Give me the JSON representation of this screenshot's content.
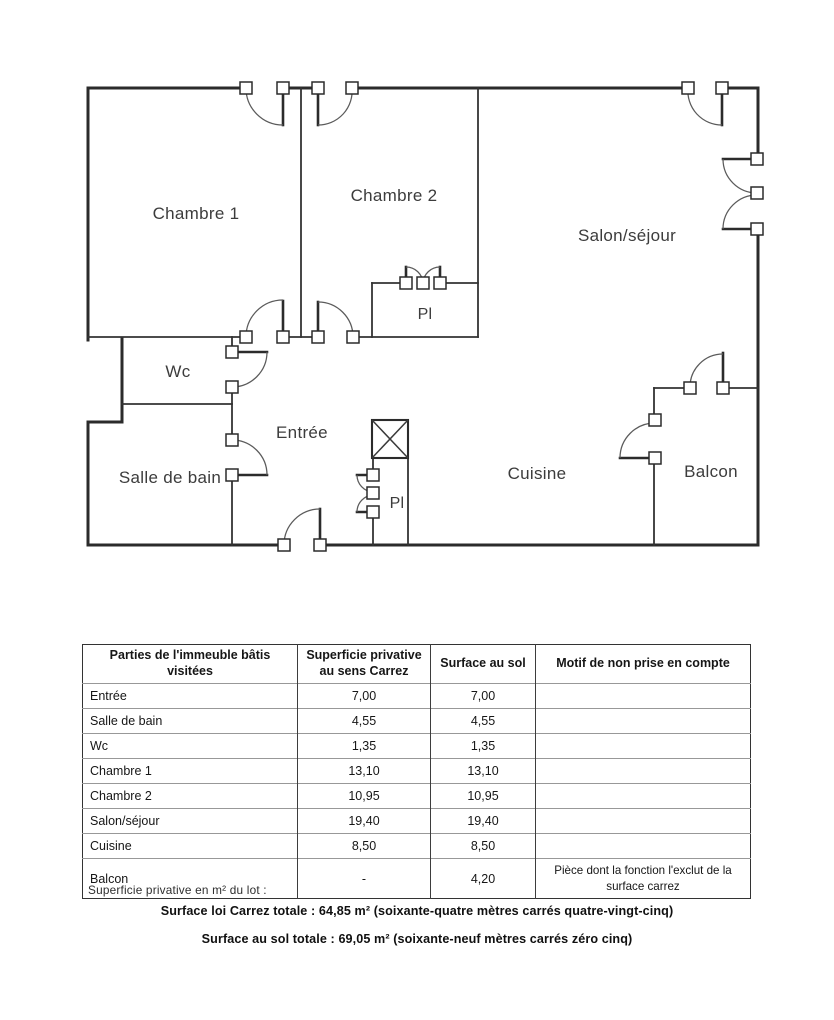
{
  "ink_color": "#2b2b2b",
  "plan": {
    "rooms": [
      {
        "id": "chambre-1",
        "label": "Chambre 1"
      },
      {
        "id": "chambre-2",
        "label": "Chambre 2"
      },
      {
        "id": "salon-sejour",
        "label": "Salon/séjour"
      },
      {
        "id": "placard-haut",
        "label": "Pl"
      },
      {
        "id": "wc",
        "label": "Wc"
      },
      {
        "id": "entree",
        "label": "Entrée"
      },
      {
        "id": "salle-de-bain",
        "label": "Salle de bain"
      },
      {
        "id": "placard-bas",
        "label": "Pl"
      },
      {
        "id": "cuisine",
        "label": "Cuisine"
      },
      {
        "id": "balcon",
        "label": "Balcon"
      }
    ]
  },
  "table": {
    "headers": [
      "Parties de l'immeuble bâtis visitées",
      "Superficie privative au sens Carrez",
      "Surface au sol",
      "Motif de non prise en compte"
    ],
    "rows": [
      {
        "room": "Entrée",
        "carrez": "7,00",
        "sol": "7,00",
        "motif": ""
      },
      {
        "room": "Salle de bain",
        "carrez": "4,55",
        "sol": "4,55",
        "motif": ""
      },
      {
        "room": "Wc",
        "carrez": "1,35",
        "sol": "1,35",
        "motif": ""
      },
      {
        "room": "Chambre 1",
        "carrez": "13,10",
        "sol": "13,10",
        "motif": ""
      },
      {
        "room": "Chambre 2",
        "carrez": "10,95",
        "sol": "10,95",
        "motif": ""
      },
      {
        "room": "Salon/séjour",
        "carrez": "19,40",
        "sol": "19,40",
        "motif": ""
      },
      {
        "room": "Cuisine",
        "carrez": "8,50",
        "sol": "8,50",
        "motif": ""
      },
      {
        "room": "Balcon",
        "carrez": "-",
        "sol": "4,20",
        "motif": "Pièce dont la fonction l'exclut de la surface carrez"
      }
    ]
  },
  "footer": {
    "lot_caption": "Superficie privative en m² du lot :",
    "carrez_total": "Surface loi Carrez totale : 64,85 m² (soixante-quatre mètres carrés quatre-vingt-cinq)",
    "floor_total": "Surface au sol totale : 69,05 m² (soixante-neuf mètres carrés zéro cinq)"
  }
}
